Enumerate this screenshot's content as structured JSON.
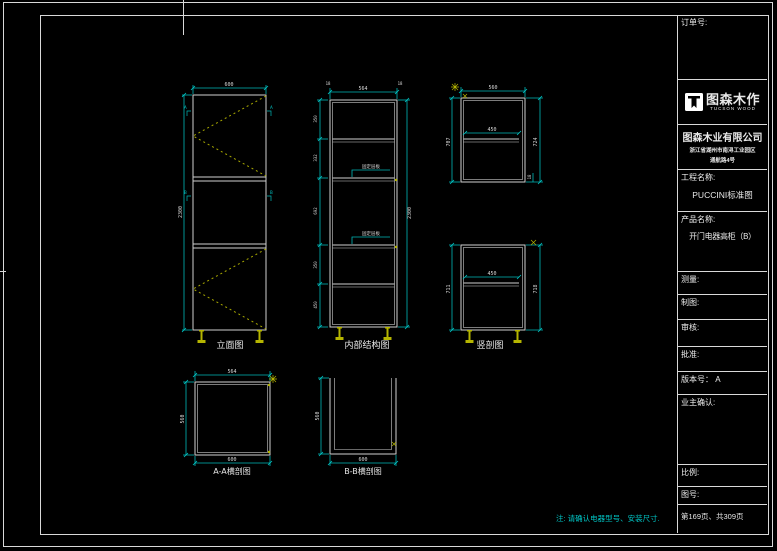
{
  "colors": {
    "background": "#000000",
    "border": "#d9d9d9",
    "cabinet_line": "#cfcfcf",
    "dimension": "#00b8b8",
    "door_swing": "#a8a800",
    "feet": "#b5b500",
    "note": "#00c6c6"
  },
  "title_block": {
    "order_label": "订单号:",
    "logo": {
      "name": "图森木作",
      "sub": "TUCSON WOOD"
    },
    "company": "图森木业有限公司",
    "address_line1": "浙江省湖州市南浔工业园区",
    "address_line2": "通航路4号",
    "project_label": "工程名称:",
    "project_value": "PUCCINI标准图",
    "product_label": "产品名称:",
    "product_value": "开门电器高柜（B）",
    "measure_label": "测量:",
    "draft_label": "制图:",
    "review_label": "审核:",
    "approve_label": "批准:",
    "version_label": "版本号： A",
    "owner_label": "业主确认:",
    "scale_label": "比例:",
    "drawing_no_label": "图号:",
    "page_info": "第169页、共309页"
  },
  "note": "注: 请确认电器型号、安装尺寸.",
  "views": {
    "elevation": {
      "label": "立面图",
      "dim_top": "600",
      "dim_left": "2300",
      "marker_a": "A",
      "marker_b": "B"
    },
    "internal": {
      "label": "内部结构图",
      "dim_top_left": "18",
      "dim_top": "564",
      "dim_top_right": "18",
      "dim_right": "2300",
      "left_dims": [
        "18",
        "350",
        "18",
        "332",
        "18",
        "692",
        "18",
        "350",
        "18",
        "450",
        "18"
      ],
      "callout": "固定层板"
    },
    "section_upper": {
      "dim_top": "560",
      "dim_inner": "450",
      "dim_left": "707",
      "dim_right": "724",
      "dim_small": "18"
    },
    "section_lower": {
      "label": "竖剖图",
      "dim_inner": "450",
      "dim_left": "711",
      "dim_right": "718"
    },
    "aa_section": {
      "label": "A-A横剖图",
      "dim_top": "564",
      "dim_left": "560",
      "dim_bottom": "600"
    },
    "bb_section": {
      "label": "B-B横剖图",
      "dim_left": "560",
      "dim_bottom": "600"
    }
  }
}
